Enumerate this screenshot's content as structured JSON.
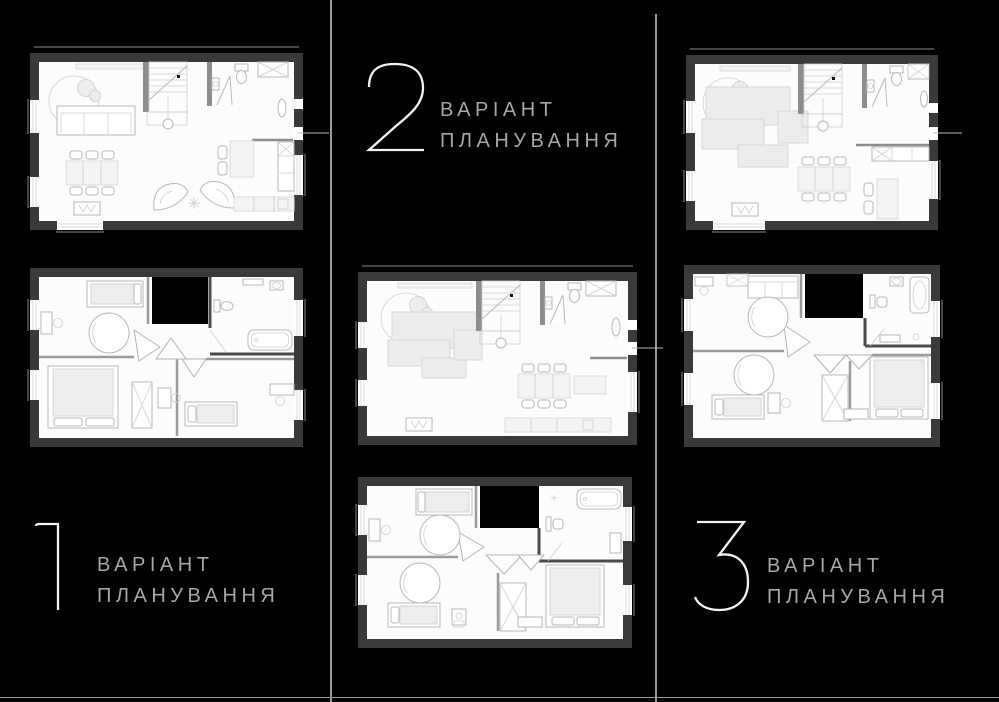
{
  "page": {
    "background": "#000000"
  },
  "dividers": {
    "color": "#9a9a9a"
  },
  "palette": {
    "wall": "#3a3a3a",
    "floor": "#fcfcfc",
    "void": "#000000",
    "line": "#b9b9b9",
    "line_thin": "#cfcfcf",
    "line_dark": "#8d8d8d",
    "fill": "#ededed",
    "fill_light": "#f3f3f3",
    "sofa_fill": "#ececec",
    "partition": "#9c9c9c",
    "partition_dark": "#4a4a4a",
    "crown_stroke": "#b3b3b3",
    "number_color": "#f2f2f2",
    "label_color": "#a6a6a6",
    "divider": "#9a9a9a"
  },
  "variants": [
    {
      "number": "1",
      "label_line1": "ВАРІАНТ",
      "label_line2": "ПЛАНУВАННЯ"
    },
    {
      "number": "2",
      "label_line1": "ВАРІАНТ",
      "label_line2": "ПЛАНУВАННЯ"
    },
    {
      "number": "3",
      "label_line1": "ВАРІАНТ",
      "label_line2": "ПЛАНУВАННЯ"
    }
  ]
}
